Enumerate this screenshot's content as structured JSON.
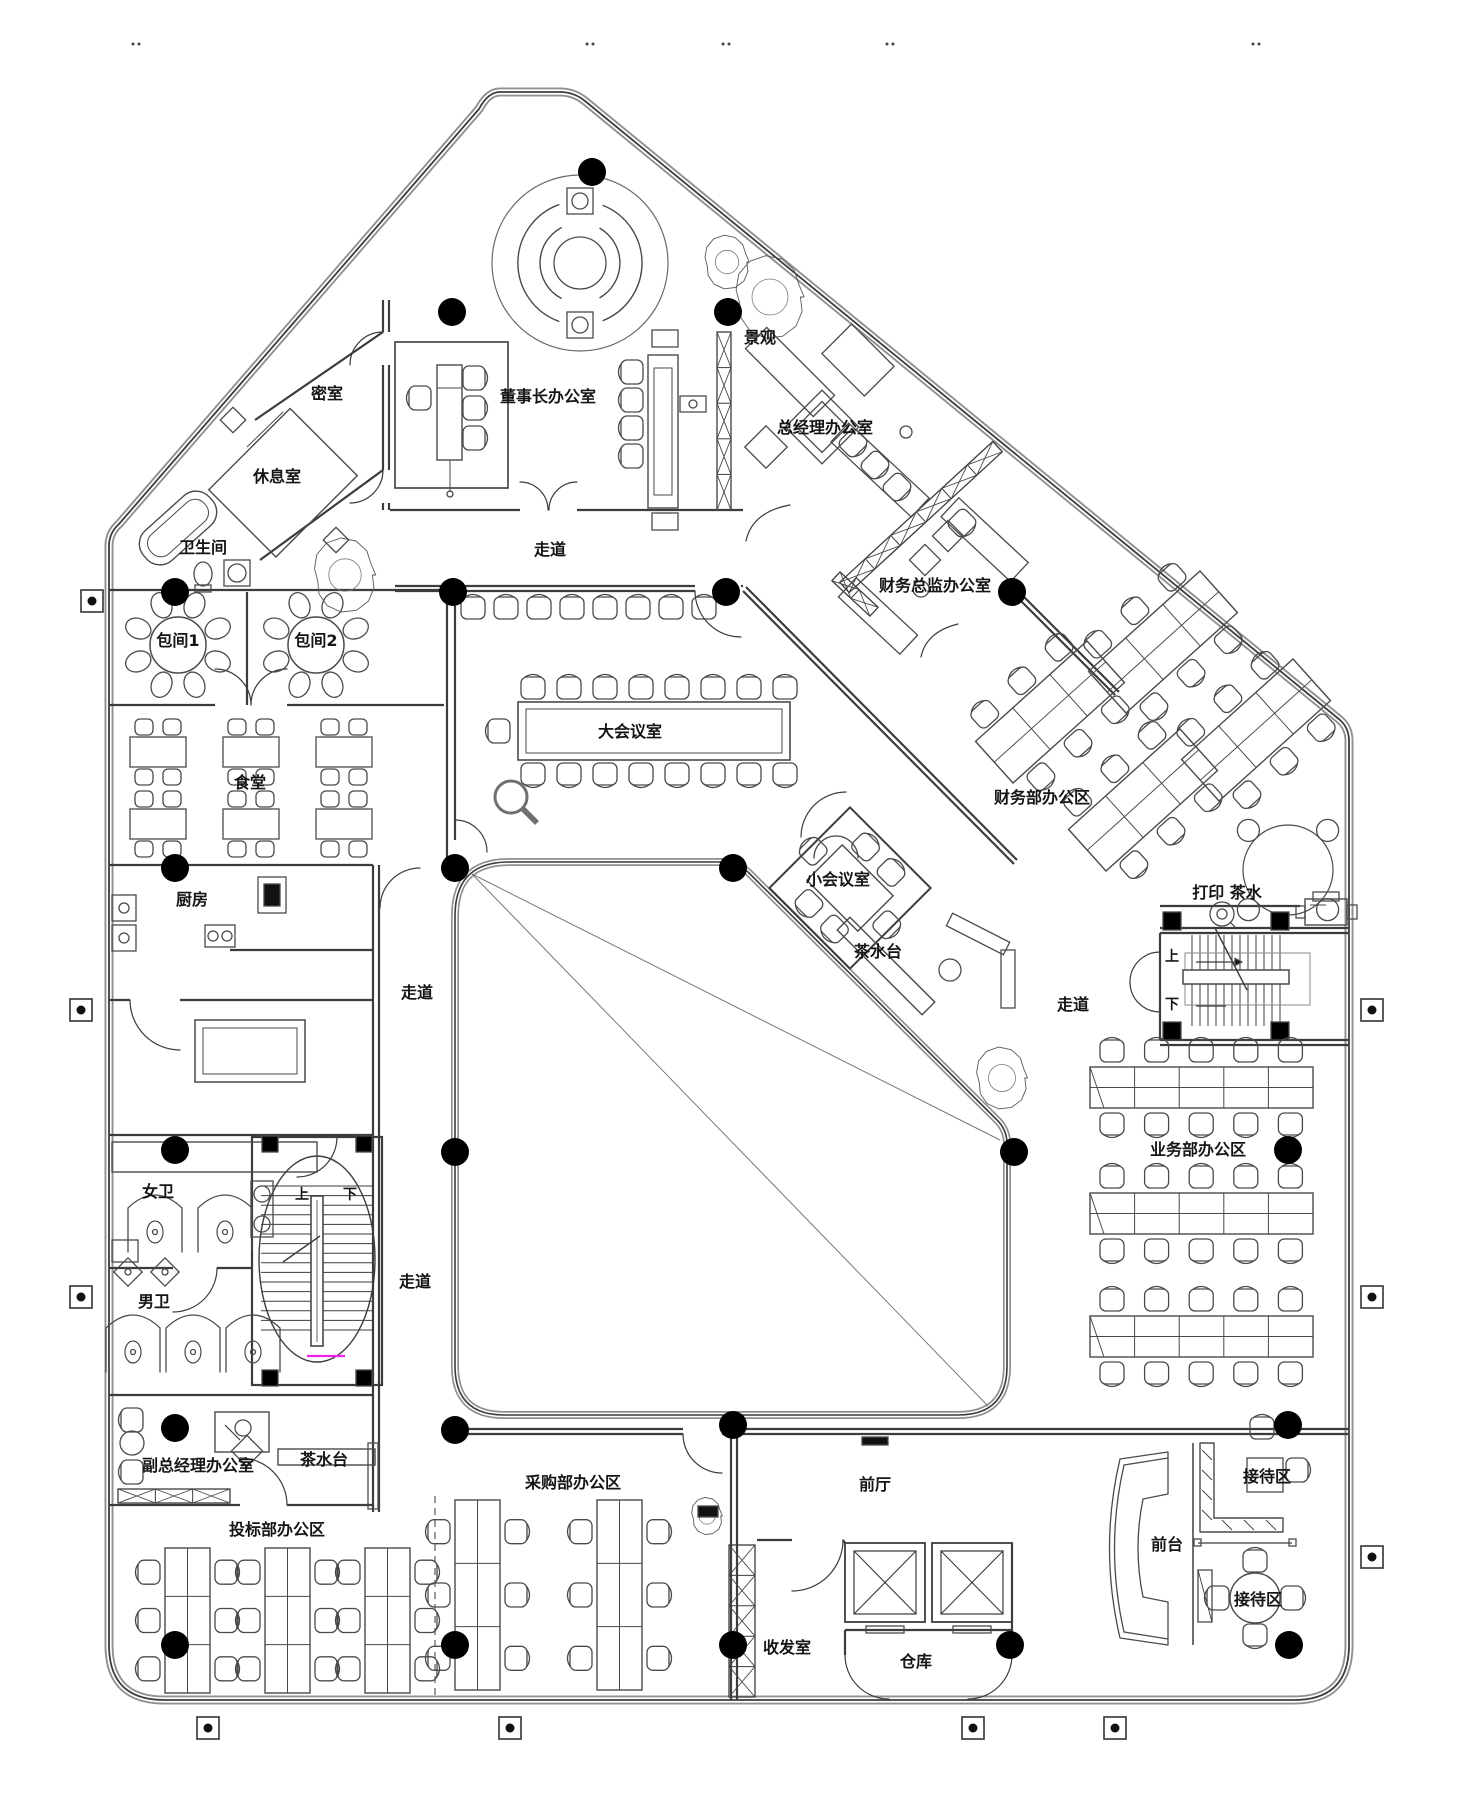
{
  "colors": {
    "background": "#ffffff",
    "line": "#3c3c3c",
    "furniture": "#4a4a4a",
    "column": "#000000",
    "highlight": "#ee22ee"
  },
  "rooms": {
    "secret_room": "密室",
    "lounge": "休息室",
    "bathroom": "卫生间",
    "chairman_office": "董事长办公室",
    "landscape": "景观",
    "gm_office": "总经理办公室",
    "cfo_office": "财务总监办公室",
    "finance_dept": "财务部办公区",
    "private_room_1": "包间1",
    "private_room_2": "包间2",
    "canteen": "食堂",
    "kitchen": "厨房",
    "corridor": "走道",
    "main_meeting_room": "大会议室",
    "small_meeting_room": "小会议室",
    "tea_station": "茶水台",
    "print_tea": "打印 茶水",
    "sales_dept": "业务部办公区",
    "women_wc": "女卫",
    "men_wc": "男卫",
    "deputy_gm_office": "副总经理办公室",
    "bidding_dept": "投标部办公区",
    "purchasing_dept": "采购部办公区",
    "front_hall": "前厅",
    "mail_room": "收发室",
    "warehouse": "仓库",
    "front_desk": "前台",
    "reception_area": "接待区"
  },
  "stairs": {
    "up": "上",
    "down": "下"
  }
}
